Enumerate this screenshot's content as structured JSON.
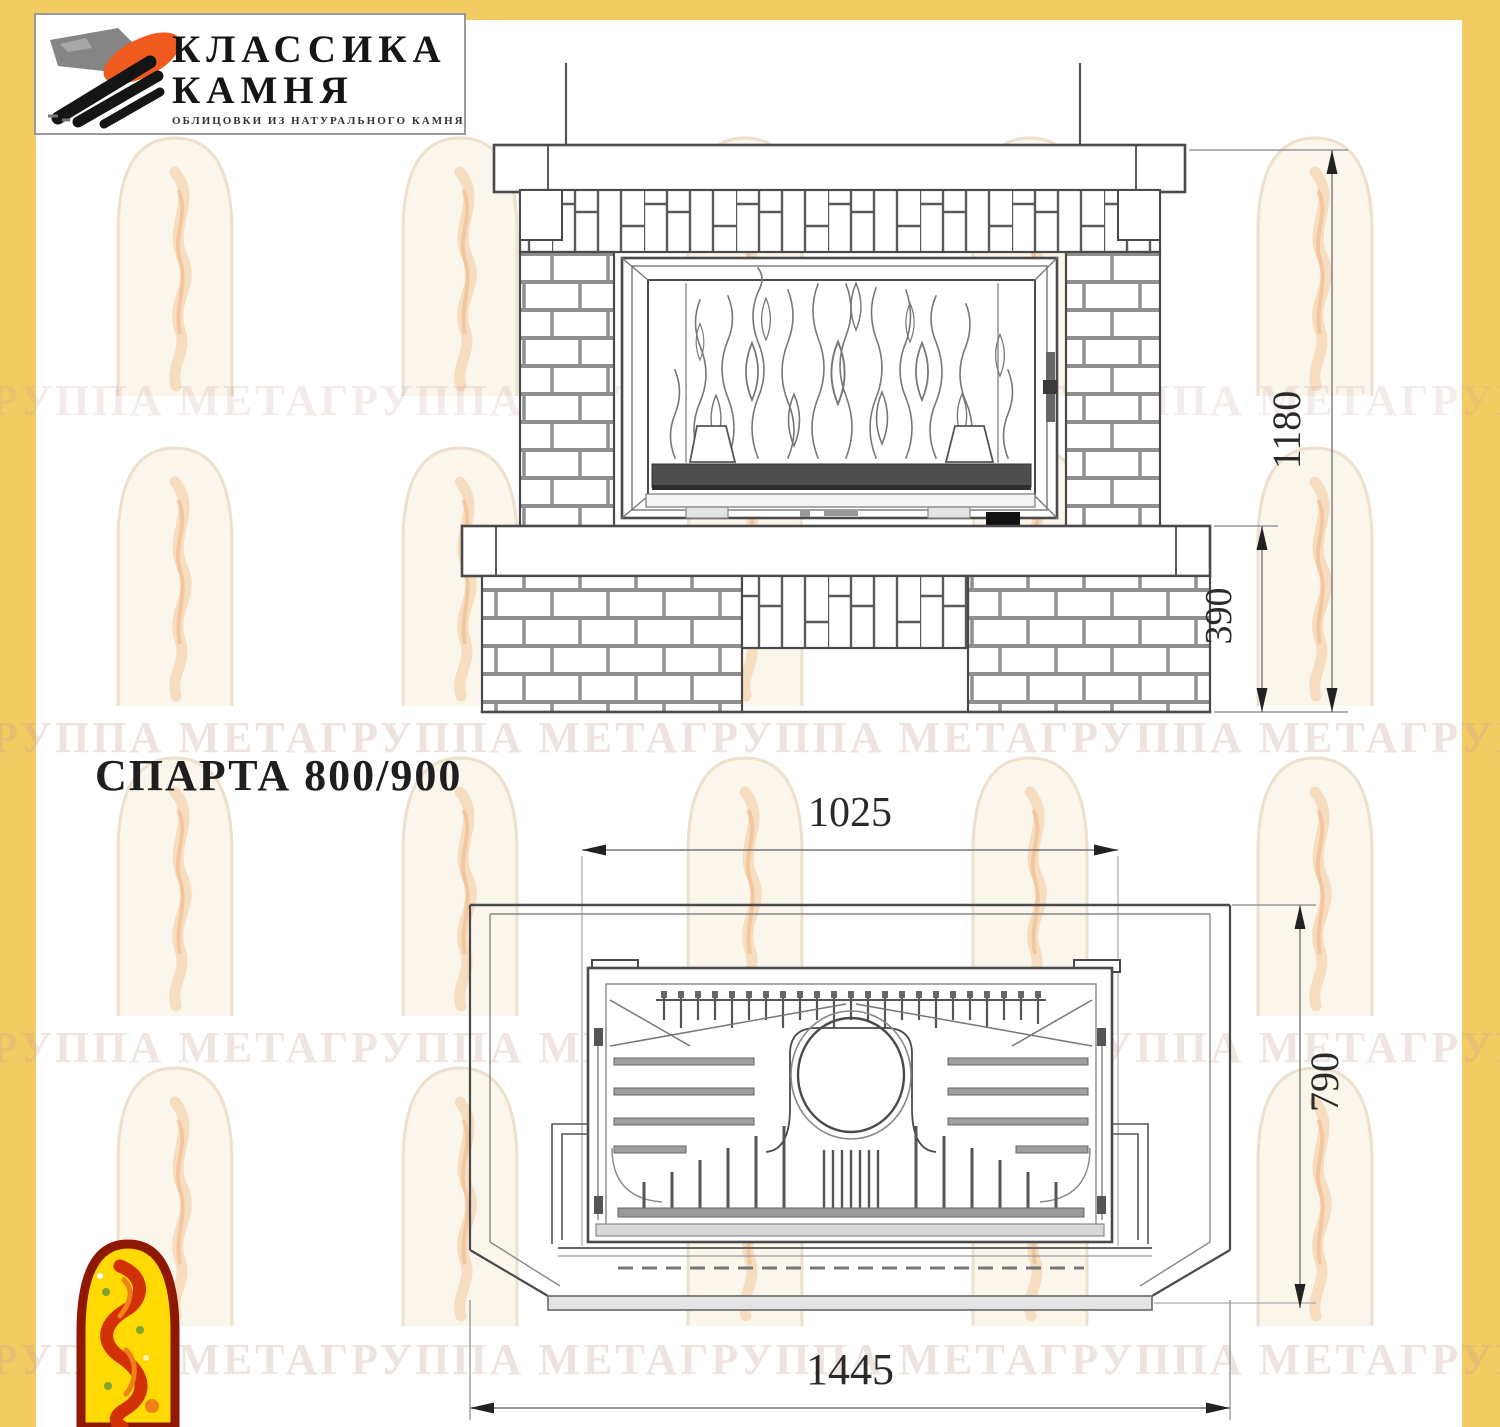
{
  "logo": {
    "line1": "КЛАССИКА",
    "line2": "КАМНЯ",
    "subtitle": "ОБЛИЦОВКИ ИЗ НАТУРАЛЬНОГО КАМНЯ"
  },
  "title": "СПАРТА 800/900",
  "watermark": {
    "phrase": "ГРУППА МЕТА",
    "row_text": "ГРУППА МЕТАГРУППА МЕТАГРУППА МЕТАГРУППА МЕТАГРУППА МЕТА"
  },
  "front_view": {
    "label": "front elevation",
    "dims": {
      "total_height": "1180",
      "base_height": "390"
    }
  },
  "plan_view": {
    "label": "top plan view",
    "dims": {
      "firebox_width": "1025",
      "depth": "790",
      "total_width": "1445"
    }
  },
  "colors": {
    "page_border": "#F2CB63",
    "drawing_line": "#4a4a4a",
    "emblem_border": "#8E1803",
    "emblem_fill": "#FFD903",
    "emblem_flame": "#D23005",
    "logo_orange": "#F05A1E",
    "logo_black": "#151515",
    "logo_gray": "#858585"
  }
}
